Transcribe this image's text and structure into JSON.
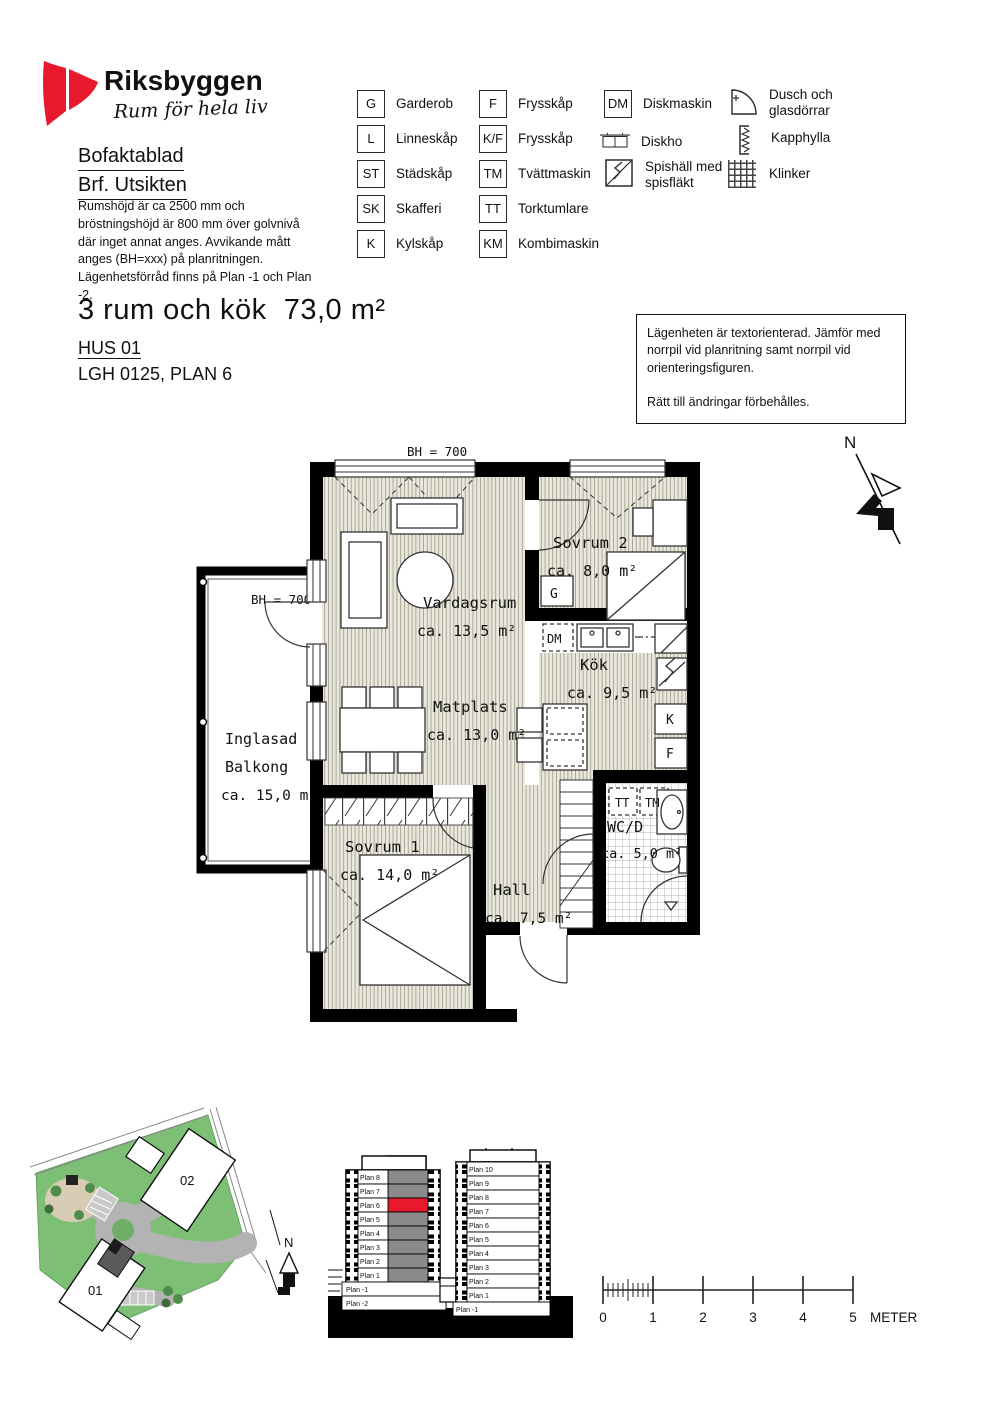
{
  "brand": {
    "name": "Riksbyggen",
    "tagline": "Rum för hela livet"
  },
  "doc": {
    "title_line1": "Bofaktablad",
    "title_line2": "Brf. Utsikten",
    "body": "Rumshöjd är ca 2500 mm och\nbröstningshöjd är 800 mm över golvnivå\ndär inget annat anges. Avvikande mått\nanges (BH=xxx) på planritningen.\nLägenhetsförråd finns på Plan -1 och Plan -2."
  },
  "legend": {
    "col1": [
      {
        "code": "G",
        "label": "Garderob"
      },
      {
        "code": "L",
        "label": "Linneskåp"
      },
      {
        "code": "ST",
        "label": "Städskåp"
      },
      {
        "code": "SK",
        "label": "Skafferi"
      },
      {
        "code": "K",
        "label": "Kylskåp"
      }
    ],
    "col2": [
      {
        "code": "F",
        "label": "Frysskåp"
      },
      {
        "code": "K/F",
        "label": "Frysskåp"
      },
      {
        "code": "TM",
        "label": "Tvättmaskin"
      },
      {
        "code": "TT",
        "label": "Torktumlare"
      },
      {
        "code": "KM",
        "label": "Kombimaskin"
      }
    ],
    "col3": [
      {
        "code": "DM",
        "label": "Diskmaskin"
      },
      {
        "icon": "sink",
        "label": "Diskho"
      },
      {
        "icon": "hob",
        "label": "Spishäll med spisfläkt"
      }
    ],
    "col4": [
      {
        "icon": "shower",
        "label": "Dusch och glasdörrar"
      },
      {
        "icon": "coatrack",
        "label": "Kapphylla"
      },
      {
        "icon": "tiles",
        "label": "Klinker"
      }
    ]
  },
  "apartment": {
    "title": "3 rum och kök  73,0 m²",
    "house": "HUS 01",
    "unit": "LGH 0125, PLAN 6"
  },
  "note": {
    "para1": "Lägenheten är textorienterad. Jämför med norrpil vid planritning samt norrpil vid orienteringsfiguren.",
    "para2": "Rätt till ändringar förbehålles."
  },
  "floorplan": {
    "bh_top": "BH = 700",
    "bh_balcony": "BH = 700",
    "north": "N",
    "balcony_mark": "ö",
    "rooms": {
      "vardagsrum": {
        "name": "Vardagsrum",
        "area": "ca. 13,5 m²"
      },
      "sovrum2": {
        "name": "Sovrum 2",
        "area": "ca. 8,0 m²"
      },
      "kok": {
        "name": "Kök",
        "area": "ca. 9,5 m²"
      },
      "matplats": {
        "name": "Matplats",
        "area": "ca. 13,0 m²"
      },
      "balkong": {
        "name1": "Inglasad",
        "name2": "Balkong",
        "area": "ca. 15,0 m²"
      },
      "sovrum1": {
        "name": "Sovrum 1",
        "area": "ca. 14,0 m²"
      },
      "hall": {
        "name": "Hall",
        "area": "ca. 7,5 m²"
      },
      "wcd": {
        "name": "WC/D",
        "area": "ca. 5,0 m²"
      }
    },
    "markers": {
      "g": "G",
      "dm": "DM",
      "k": "K",
      "f": "F",
      "tt": "TT",
      "tm": "TM"
    }
  },
  "site": {
    "b01": "01",
    "b02": "02",
    "north": "N"
  },
  "elevations": {
    "highlight": "Plan 6",
    "hus01": [
      "Plan 8",
      "Plan 7",
      "Plan 6",
      "Plan 5",
      "Plan 4",
      "Plan 3",
      "Plan 2",
      "Plan 1",
      "Plan -1",
      "Plan -2"
    ],
    "hus02": [
      "Plan 10",
      "Plan 9",
      "Plan 8",
      "Plan 7",
      "Plan 6",
      "Plan 5",
      "Plan 4",
      "Plan 3",
      "Plan 2",
      "Plan 1",
      "Plan -1"
    ]
  },
  "scalebar": {
    "labels": [
      "0",
      "1",
      "2",
      "3",
      "4",
      "5"
    ],
    "unit": "METER"
  },
  "colors": {
    "accent_red": "#e8192c",
    "elevation_gray": "#8a8a8a",
    "floor_beige": "#eae8dc",
    "site_green": "#7cbf75",
    "road_gray": "#b3b3b3",
    "playground_tan": "#d8cdb4",
    "logo_gray": "#9b9b9b"
  }
}
